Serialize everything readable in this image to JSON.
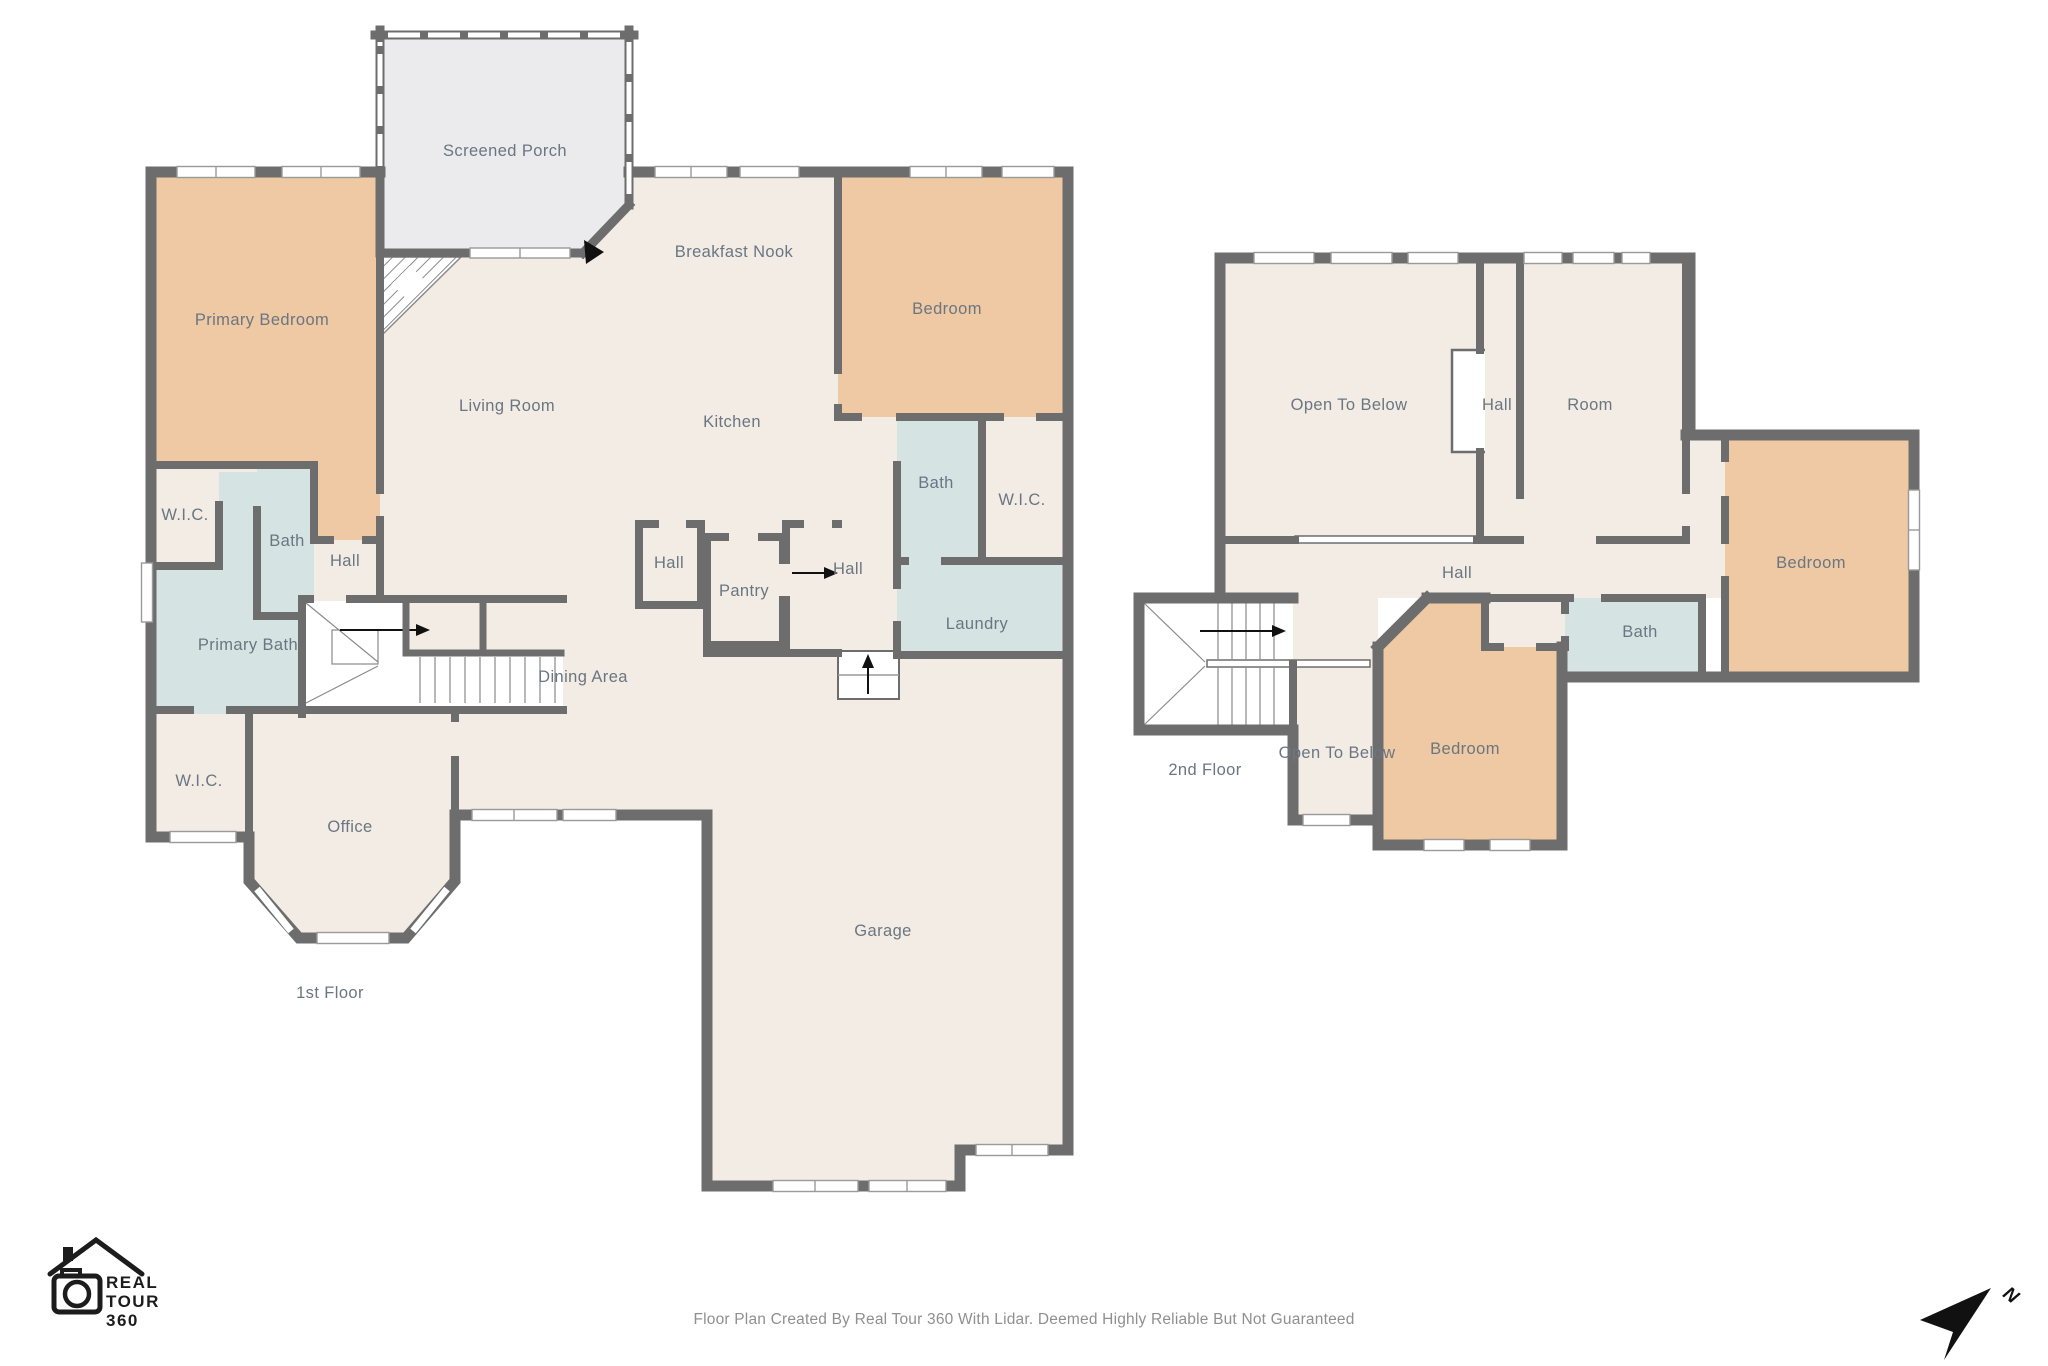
{
  "title": "Residential Floor Plan",
  "colors": {
    "wall": "#6d6d6d",
    "room_beige": "#f3ece5",
    "bedroom_tan": "#eec9a3",
    "bath_blue": "#d6e3e3",
    "porch_gray": "#ebebed",
    "label_text": "#6a7682",
    "footer_text": "#8f8f8f",
    "logo_black": "#1c1c1c"
  },
  "floor1": {
    "name": "1st Floor",
    "rooms": {
      "screened_porch": "Screened Porch",
      "primary_bedroom": "Primary Bedroom",
      "breakfast_nook": "Breakfast Nook",
      "bedroom": "Bedroom",
      "living_room": "Living Room",
      "kitchen": "Kitchen",
      "wic_top": "W.I.C.",
      "bath": "Bath",
      "hall_1": "Hall",
      "primary_bath": "Primary Bath",
      "wic_left": "W.I.C.",
      "office": "Office",
      "dining_area": "Dining Area",
      "hall_2": "Hall",
      "pantry": "Pantry",
      "hall_3": "Hall",
      "bath_center": "Bath",
      "wic_right": "W.I.C.",
      "laundry": "Laundry",
      "garage": "Garage"
    }
  },
  "floor2": {
    "name": "2nd Floor",
    "rooms": {
      "open_to_below": "Open To Below",
      "hall_upper": "Hall",
      "room": "Room",
      "hall_mid": "Hall",
      "bedroom_right": "Bedroom",
      "bath": "Bath",
      "bedroom_bottom": "Bedroom",
      "open_to_below_small": "Open To Below"
    }
  },
  "logo": {
    "line1": "REAL",
    "line2": "TOUR",
    "line3": "360"
  },
  "compass": {
    "north_label": "N"
  },
  "footer": {
    "text": "Floor Plan Created By Real Tour 360 With Lidar. Deemed Highly Reliable But Not Guaranteed"
  }
}
